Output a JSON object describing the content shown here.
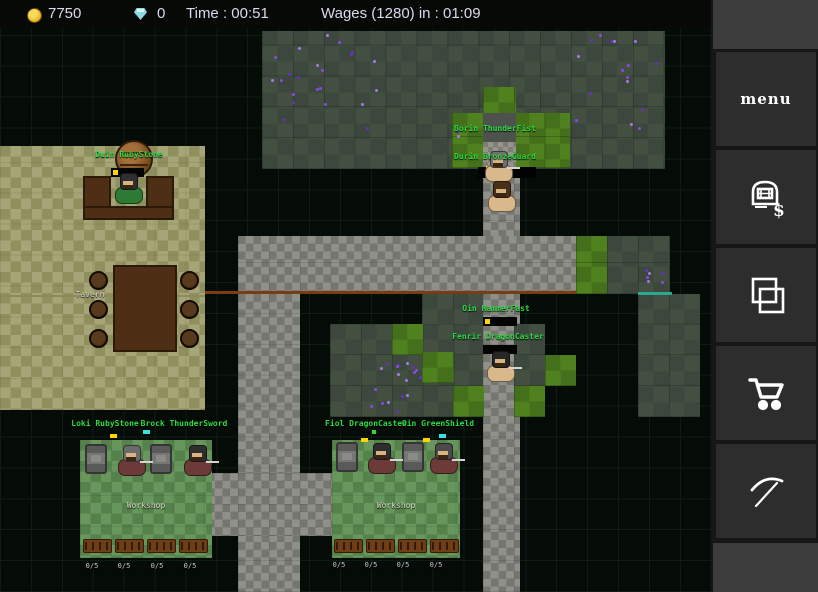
{
  "top_bar": {
    "gold": "7750",
    "gems": "0",
    "time_label": "Time : 00:51",
    "wages_label": "Wages (1280) in : 01:09",
    "gold_color": "#e3af1d",
    "gem_color": "#8fd8e0",
    "text_color": "#dcd9ef"
  },
  "sidebar": {
    "menu_label": "menu",
    "buttons": [
      {
        "name": "menu",
        "icon": "menu-text"
      },
      {
        "name": "hire",
        "icon": "hut-dollar-icon"
      },
      {
        "name": "build",
        "icon": "overlapping-squares-icon"
      },
      {
        "name": "shop",
        "icon": "shopping-cart-icon"
      },
      {
        "name": "mine",
        "icon": "pickaxe-icon"
      }
    ]
  },
  "map": {
    "colors": {
      "name_green": "#2edb43",
      "ore_purple": "#8a4ae0",
      "fence_brown": "#7a3c12",
      "door_teal": "#2aa890"
    },
    "regions": [
      {
        "t": "sage",
        "x": 262,
        "y": 31,
        "w": 403,
        "h": 138
      },
      {
        "t": "grass",
        "x": 452,
        "y": 113,
        "w": 118,
        "h": 55
      },
      {
        "t": "grass",
        "x": 483,
        "y": 87,
        "w": 33,
        "h": 28
      },
      {
        "t": "graytile",
        "x": 483,
        "y": 113,
        "w": 33,
        "h": 29
      },
      {
        "t": "stonetile",
        "x": 483,
        "y": 142,
        "w": 33,
        "h": 26
      },
      {
        "t": "cobble",
        "x": 483,
        "y": 168,
        "w": 37,
        "h": 424
      },
      {
        "t": "cobble",
        "x": 238,
        "y": 236,
        "w": 338,
        "h": 58
      },
      {
        "t": "cobble",
        "x": 238,
        "y": 294,
        "w": 62,
        "h": 298
      },
      {
        "t": "cobble",
        "x": 207,
        "y": 473,
        "w": 125,
        "h": 63
      },
      {
        "t": "khaki",
        "x": 0,
        "y": 146,
        "w": 205,
        "h": 264
      },
      {
        "t": "sage",
        "x": 422,
        "y": 294,
        "w": 61,
        "h": 31
      },
      {
        "t": "sage",
        "x": 330,
        "y": 324,
        "w": 153,
        "h": 93
      },
      {
        "t": "grass",
        "x": 392,
        "y": 324,
        "w": 31,
        "h": 31
      },
      {
        "t": "grass",
        "x": 422,
        "y": 352,
        "w": 32,
        "h": 31
      },
      {
        "t": "grass",
        "x": 453,
        "y": 386,
        "w": 31,
        "h": 31
      },
      {
        "t": "grass",
        "x": 576,
        "y": 236,
        "w": 31,
        "h": 58
      },
      {
        "t": "sage",
        "x": 607,
        "y": 236,
        "w": 63,
        "h": 58
      },
      {
        "t": "sage",
        "x": 638,
        "y": 294,
        "w": 62,
        "h": 123
      },
      {
        "t": "sage",
        "x": 514,
        "y": 324,
        "w": 31,
        "h": 62
      },
      {
        "t": "grass",
        "x": 514,
        "y": 386,
        "w": 31,
        "h": 31
      },
      {
        "t": "grass",
        "x": 545,
        "y": 355,
        "w": 31,
        "h": 31
      },
      {
        "t": "wgreen",
        "x": 80,
        "y": 440,
        "w": 132,
        "h": 118
      },
      {
        "t": "wgreen",
        "x": 332,
        "y": 440,
        "w": 128,
        "h": 118
      }
    ],
    "fences": [
      {
        "x": 205,
        "y": 291,
        "w": 371,
        "h": 3,
        "c": "#7a3c12"
      },
      {
        "x": 638,
        "y": 292,
        "w": 34,
        "h": 3,
        "c": "#2aa890"
      },
      {
        "x": 0,
        "y": 295,
        "w": 205,
        "h": 2,
        "c": "#8a8a5a"
      }
    ],
    "ore_clusters": [
      {
        "x": 265,
        "y": 33,
        "w": 118,
        "h": 100,
        "n": 22
      },
      {
        "x": 573,
        "y": 33,
        "w": 90,
        "h": 100,
        "n": 16
      },
      {
        "x": 360,
        "y": 353,
        "w": 64,
        "h": 62,
        "n": 18
      },
      {
        "x": 640,
        "y": 263,
        "w": 30,
        "h": 26,
        "n": 6
      },
      {
        "x": 452,
        "y": 120,
        "w": 24,
        "h": 20,
        "n": 3
      }
    ],
    "props": [
      {
        "t": "opening",
        "x": 478,
        "y": 167,
        "w": 58,
        "h": 11
      },
      {
        "t": "barrel",
        "x": 115,
        "y": 140,
        "w": 38,
        "h": 38
      },
      {
        "t": "wood",
        "x": 83,
        "y": 176,
        "w": 28,
        "h": 44
      },
      {
        "t": "wood",
        "x": 146,
        "y": 176,
        "w": 28,
        "h": 44
      },
      {
        "t": "wood",
        "x": 83,
        "y": 206,
        "w": 91,
        "h": 14
      },
      {
        "t": "wood",
        "x": 113,
        "y": 265,
        "w": 64,
        "h": 87
      },
      {
        "t": "stool",
        "x": 89,
        "y": 271,
        "w": 19,
        "h": 19
      },
      {
        "t": "stool",
        "x": 89,
        "y": 300,
        "w": 19,
        "h": 19
      },
      {
        "t": "stool",
        "x": 89,
        "y": 329,
        "w": 19,
        "h": 19
      },
      {
        "t": "stool",
        "x": 180,
        "y": 271,
        "w": 19,
        "h": 19
      },
      {
        "t": "stool",
        "x": 180,
        "y": 300,
        "w": 19,
        "h": 19
      },
      {
        "t": "stool",
        "x": 180,
        "y": 329,
        "w": 19,
        "h": 19
      },
      {
        "t": "anvil",
        "x": 85,
        "y": 444,
        "w": 22,
        "h": 30
      },
      {
        "t": "anvil",
        "x": 150,
        "y": 444,
        "w": 22,
        "h": 30
      },
      {
        "t": "anvil",
        "x": 336,
        "y": 442,
        "w": 22,
        "h": 30
      },
      {
        "t": "anvil",
        "x": 402,
        "y": 442,
        "w": 22,
        "h": 30
      },
      {
        "t": "bench",
        "x": 83,
        "y": 539,
        "w": 29,
        "h": 14
      },
      {
        "t": "bench",
        "x": 115,
        "y": 539,
        "w": 29,
        "h": 14
      },
      {
        "t": "bench",
        "x": 147,
        "y": 539,
        "w": 29,
        "h": 14
      },
      {
        "t": "bench",
        "x": 179,
        "y": 539,
        "w": 29,
        "h": 14
      },
      {
        "t": "bench",
        "x": 334,
        "y": 539,
        "w": 29,
        "h": 14
      },
      {
        "t": "bench",
        "x": 366,
        "y": 539,
        "w": 29,
        "h": 14
      },
      {
        "t": "bench",
        "x": 398,
        "y": 539,
        "w": 29,
        "h": 14
      },
      {
        "t": "bench",
        "x": 430,
        "y": 539,
        "w": 29,
        "h": 14
      }
    ],
    "bars": [
      {
        "x": 111,
        "y": 168,
        "w": 33,
        "h": 9,
        "chunk": "#ffd400"
      },
      {
        "x": 483,
        "y": 317,
        "w": 34,
        "h": 9,
        "chunk": "#ffd400"
      },
      {
        "x": 483,
        "y": 345,
        "w": 34,
        "h": 9,
        "chunk": null
      }
    ],
    "markers": [
      {
        "x": 486,
        "y": 166,
        "w": 5,
        "h": 4,
        "c": "#ffd400"
      },
      {
        "x": 486,
        "y": 171,
        "w": 5,
        "h": 4,
        "c": "#35e0e0"
      },
      {
        "x": 110,
        "y": 434,
        "w": 7,
        "h": 4,
        "c": "#ffd400"
      },
      {
        "x": 143,
        "y": 430,
        "w": 7,
        "h": 4,
        "c": "#35e0e0"
      },
      {
        "x": 361,
        "y": 438,
        "w": 7,
        "h": 4,
        "c": "#ffd400"
      },
      {
        "x": 423,
        "y": 438,
        "w": 7,
        "h": 4,
        "c": "#ffd400"
      },
      {
        "x": 439,
        "y": 434,
        "w": 7,
        "h": 4,
        "c": "#35e0e0"
      },
      {
        "x": 372,
        "y": 430,
        "w": 4,
        "h": 4,
        "c": "#35d435"
      }
    ],
    "labels": [
      {
        "text": "Duin RubyStone",
        "x": 129,
        "y": 150,
        "style": "green"
      },
      {
        "text": "Borin ThunderFist",
        "x": 495,
        "y": 124,
        "style": "green"
      },
      {
        "text": "Durin BronzeGuard",
        "x": 495,
        "y": 152,
        "style": "green"
      },
      {
        "text": "Oin HammerFast",
        "x": 496,
        "y": 304,
        "style": "green"
      },
      {
        "text": "Fenrir DragonCaster",
        "x": 498,
        "y": 332,
        "style": "green"
      },
      {
        "text": "Loki RubyStone",
        "x": 105,
        "y": 419,
        "style": "green"
      },
      {
        "text": "Brock ThunderSword",
        "x": 184,
        "y": 419,
        "style": "green"
      },
      {
        "text": "Fiol DragonCaster",
        "x": 366,
        "y": 419,
        "style": "green"
      },
      {
        "text": "Oin GreenShield",
        "x": 438,
        "y": 419,
        "style": "green"
      },
      {
        "text": "Tavern",
        "x": 90,
        "y": 290,
        "style": "white"
      },
      {
        "text": "Workshop",
        "x": 146,
        "y": 501,
        "style": "white"
      },
      {
        "text": "Workshop",
        "x": 396,
        "y": 501,
        "style": "white"
      }
    ],
    "counters": [
      {
        "text": "0/5",
        "x": 92,
        "y": 562
      },
      {
        "text": "0/5",
        "x": 124,
        "y": 562
      },
      {
        "text": "0/5",
        "x": 157,
        "y": 562
      },
      {
        "text": "0/5",
        "x": 190,
        "y": 562
      },
      {
        "text": "0/5",
        "x": 339,
        "y": 561
      },
      {
        "text": "0/5",
        "x": 371,
        "y": 561
      },
      {
        "text": "0/5",
        "x": 403,
        "y": 561
      },
      {
        "text": "0/5",
        "x": 436,
        "y": 561
      }
    ],
    "characters": [
      {
        "who": "bartender",
        "x": 113,
        "y": 172,
        "hair": "#2f2f2f",
        "body": "#2c7a33",
        "tool": false
      },
      {
        "who": "durin-bronzeguard",
        "x": 483,
        "y": 150,
        "hair": "#707070",
        "body": "#d9b98c",
        "tool": true
      },
      {
        "who": "borin-thunderfist",
        "x": 486,
        "y": 180,
        "hair": "#4a3018",
        "body": "#d9b98c",
        "tool": false
      },
      {
        "who": "oin-miner",
        "x": 485,
        "y": 350,
        "hair": "#262626",
        "body": "#d9b98c",
        "tool": true
      },
      {
        "who": "workshop1-smith1",
        "x": 116,
        "y": 444,
        "hair": "#6a6a6a",
        "body": "#6d3a3a",
        "tool": true
      },
      {
        "who": "workshop1-smith2",
        "x": 182,
        "y": 444,
        "hair": "#2e2e2e",
        "body": "#6d3a3a",
        "tool": true
      },
      {
        "who": "workshop2-smith1",
        "x": 366,
        "y": 442,
        "hair": "#2e2e2e",
        "body": "#6d3a3a",
        "tool": true
      },
      {
        "who": "workshop2-smith2",
        "x": 428,
        "y": 442,
        "hair": "#4a4a4a",
        "body": "#6d3a3a",
        "tool": true
      }
    ]
  }
}
